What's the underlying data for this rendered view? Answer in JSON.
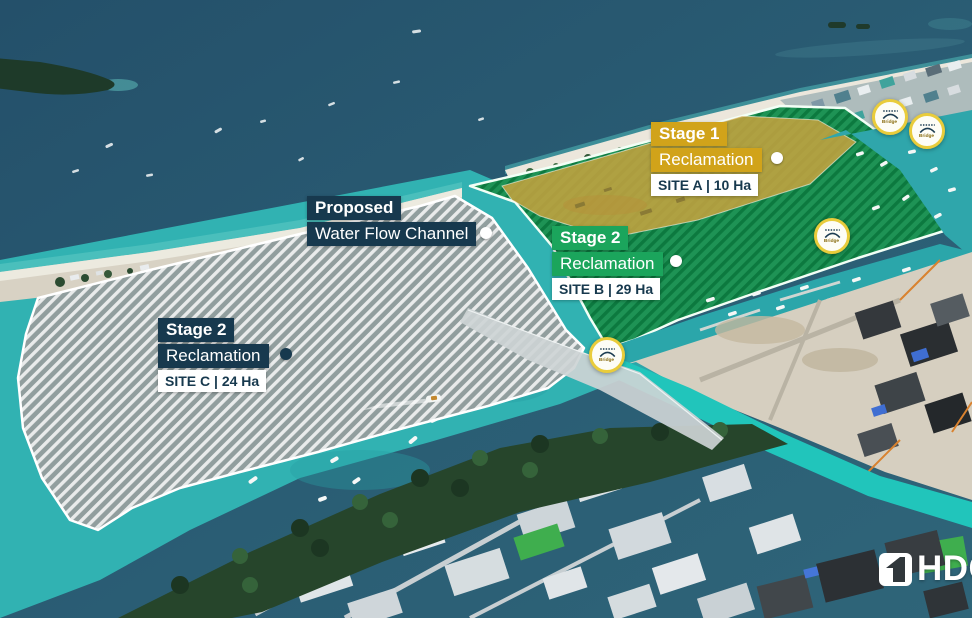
{
  "colors": {
    "gold": "#d1a31a",
    "green": "#1ba55c",
    "navy": "#17394e",
    "ring": "#e9cc3b"
  },
  "annotations": {
    "water_channel": {
      "line1": "Proposed",
      "line2": "Water Flow Channel"
    },
    "site_a": {
      "stage": "Stage 1",
      "activity": "Reclamation",
      "detail": "SITE A | 10 Ha"
    },
    "site_b": {
      "stage": "Stage 2",
      "activity": "Reclamation",
      "detail": "SITE B | 29 Ha"
    },
    "site_c": {
      "stage": "Stage 2",
      "activity": "Reclamation",
      "detail": "SITE C | 24 Ha"
    }
  },
  "markers": {
    "bridge_label": "Bridge"
  },
  "branding": {
    "logo_text": "HDC"
  }
}
